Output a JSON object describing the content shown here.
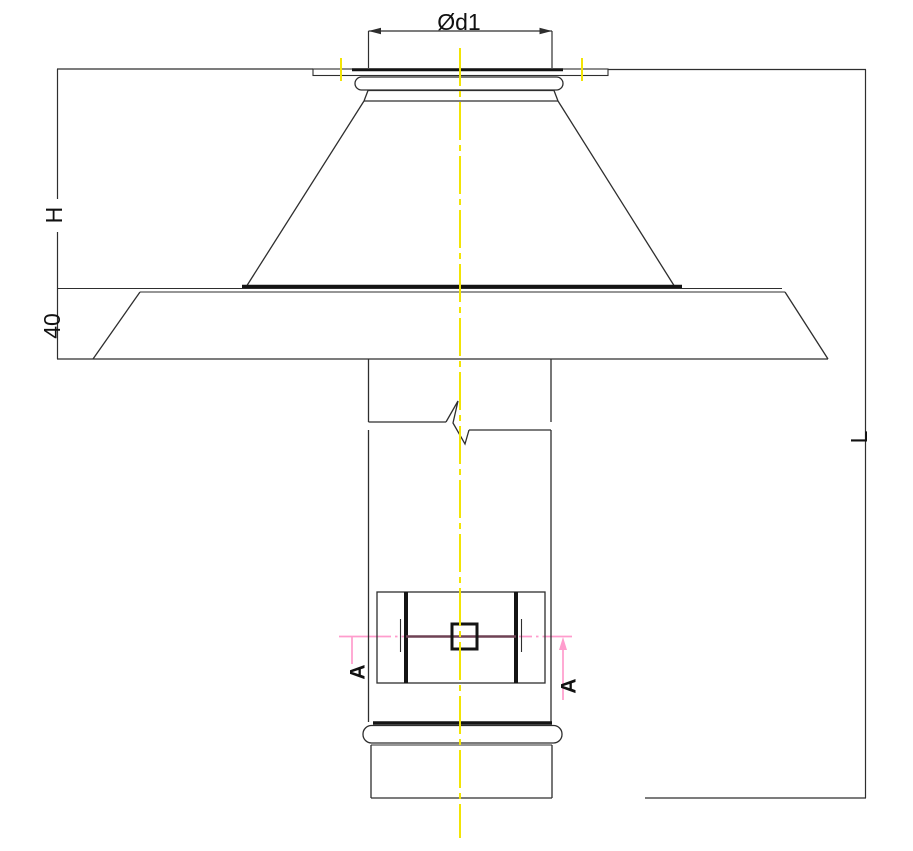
{
  "drawing": {
    "type": "technical-cad-drawing",
    "description": "Roof chimney terminal / cowl with cone cap, base plate and connection pipe, front elevation with dimensions",
    "labels": {
      "top_diameter": "Ød1",
      "cone_height": "H",
      "plate_height": "40",
      "pipe_length": "L",
      "section_left": "A",
      "section_right": "A"
    },
    "colors": {
      "line": "#2e2e2e",
      "thick_line": "#141414",
      "centerline": "#f2e405",
      "section_line": "#ff9ccd",
      "damper_axis": "#6e4154",
      "background": "#ffffff",
      "label": "#111111"
    }
  }
}
